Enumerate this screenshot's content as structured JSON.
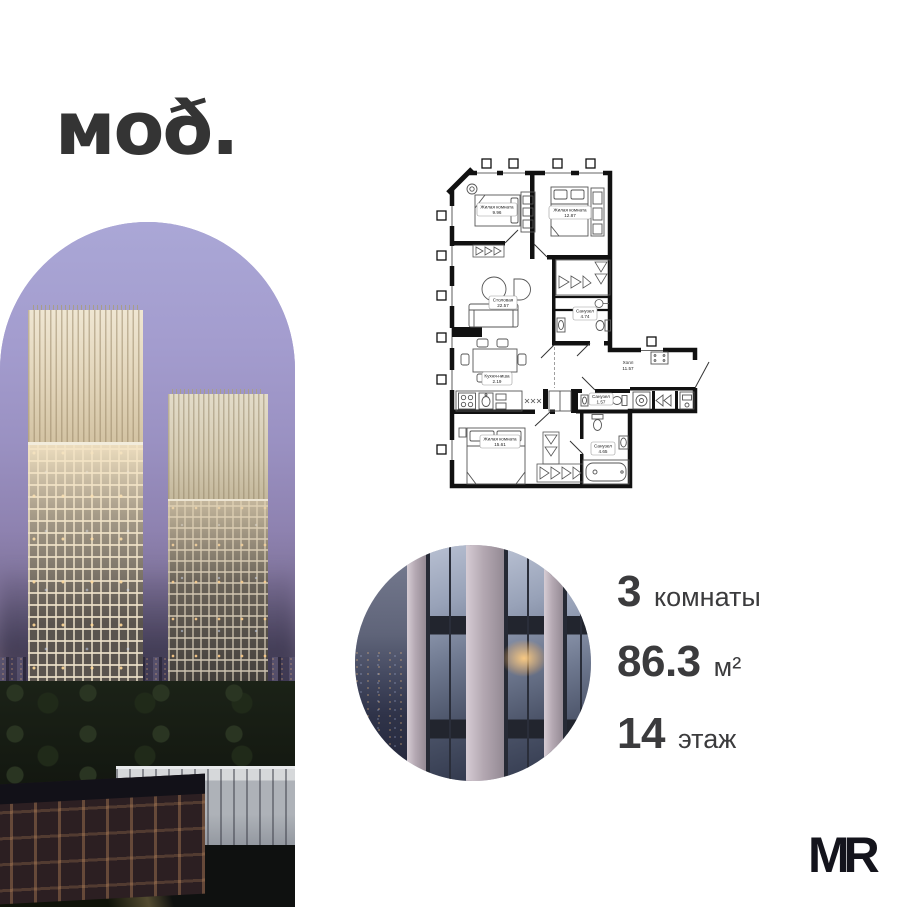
{
  "brand": {
    "logo_text": "моð."
  },
  "footer": {
    "developer_logo": "MR"
  },
  "listing": {
    "rooms": {
      "value": "3",
      "label": "комнаты"
    },
    "area": {
      "value": "86.3",
      "label": "м²"
    },
    "floor": {
      "value": "14",
      "label": "этаж"
    }
  },
  "floorplan": {
    "rooms": [
      {
        "name": "Жилая комната",
        "area": "9.96"
      },
      {
        "name": "Жилая комната",
        "area": "12.87"
      },
      {
        "name": "Столовая",
        "area": "22.57"
      },
      {
        "name": "Санузел",
        "area": "4.74"
      },
      {
        "name": "Кухня-ниша",
        "area": "2.19"
      },
      {
        "name": "Холл",
        "area": "11.57"
      },
      {
        "name": "Санузел",
        "area": "1.57"
      },
      {
        "name": "Санузел",
        "area": "4.65"
      },
      {
        "name": "Жилая комната",
        "area": "15.61"
      }
    ]
  },
  "colors": {
    "background": "#ffffff",
    "text": "#3b3b3d",
    "logo": "#343434",
    "plan_walls": "#111111",
    "sky": "#a29bcb"
  }
}
